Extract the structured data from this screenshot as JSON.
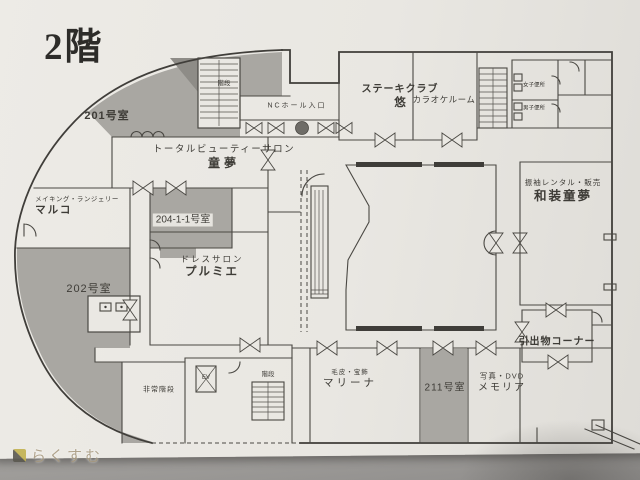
{
  "floor_title": "2階",
  "watermark": {
    "text": "らくすむ"
  },
  "labels": {
    "room201": {
      "name": "201号室"
    },
    "stairs_top": {
      "name": "階段"
    },
    "beauty_salon": {
      "category": "トータルビューティーサロン",
      "name": "童夢"
    },
    "nc_hall_entrance": {
      "name": "NCホール入口"
    },
    "steak_club": {
      "category": "ステーキクラブ",
      "name": "悠"
    },
    "karaoke": {
      "name": "カラオケルーム"
    },
    "toilet_women": {
      "name": "女子便所"
    },
    "toilet_men": {
      "name": "男子便所"
    },
    "kimono_shop": {
      "category": "振袖レンタル・販売",
      "name": "和装童夢"
    },
    "gift_corner": {
      "name": "引出物コーナー"
    },
    "photo_shop": {
      "category": "写真・DVD",
      "name": "メモリア"
    },
    "room211": {
      "name": "211号室"
    },
    "fur_jewelry": {
      "category": "毛皮・宝飾",
      "name": "マリーナ"
    },
    "stairs_bottom": {
      "name": "階段"
    },
    "elevator": {
      "name": "EV"
    },
    "emergency_stairs": {
      "name": "非常階段"
    },
    "lingerie_shop": {
      "category": "メイキング・ランジェリー",
      "name": "マルコ"
    },
    "room204": {
      "name": "204-1-1号室"
    },
    "room202": {
      "name": "202号室"
    },
    "dress_salon": {
      "category": "ドレスサロン",
      "name": "プルミエ"
    }
  },
  "colors": {
    "ink": "#44423d",
    "paper": "#eae8e3",
    "shaded_room": "#a9a7a2",
    "watermark_text": "#a89a80",
    "watermark_icon_yellow": "#c2b14e",
    "watermark_icon_dark": "#5a584f"
  }
}
